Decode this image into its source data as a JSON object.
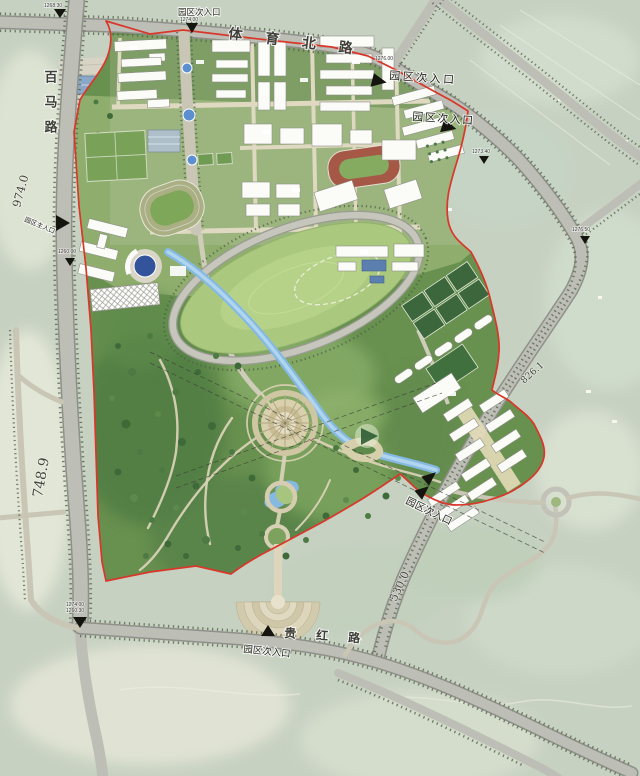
{
  "map": {
    "road_names": {
      "tiyu_north": "体育北路",
      "baima": "百马路",
      "guihong": "贵红路"
    },
    "entrances": {
      "main": "园区主入口",
      "secondary": "园区次入口"
    },
    "spot_elevations": {
      "e1268_30": "1268.30",
      "e1274_00": "1274.00",
      "e1276_00": "1276.00",
      "e1273_40": "1273.40",
      "e1276_50": "1276.50",
      "e1260_00": "1260.00",
      "e1274_00b": "1274.00",
      "e1260_30": "1260.30"
    },
    "terrain_elevations": {
      "e974": "974.0",
      "e748": "748.9",
      "e826": "826.1",
      "e530": "530.0"
    },
    "icons": {
      "entrance_arrow": "▲",
      "play_overlay": "▶"
    },
    "colors": {
      "boundary_red": "#d9372a",
      "water_blue": "#86b9e2",
      "water_core": "#b5d8f0",
      "road_gray": "#bdbeb6",
      "park_green": "#68904f",
      "campus_lawn": "#8fae6d",
      "oval_green": "#abc97e",
      "track_red": "#a65847",
      "sand_path": "#d9d2b6",
      "satellite_base": "#c7d1c2"
    }
  }
}
